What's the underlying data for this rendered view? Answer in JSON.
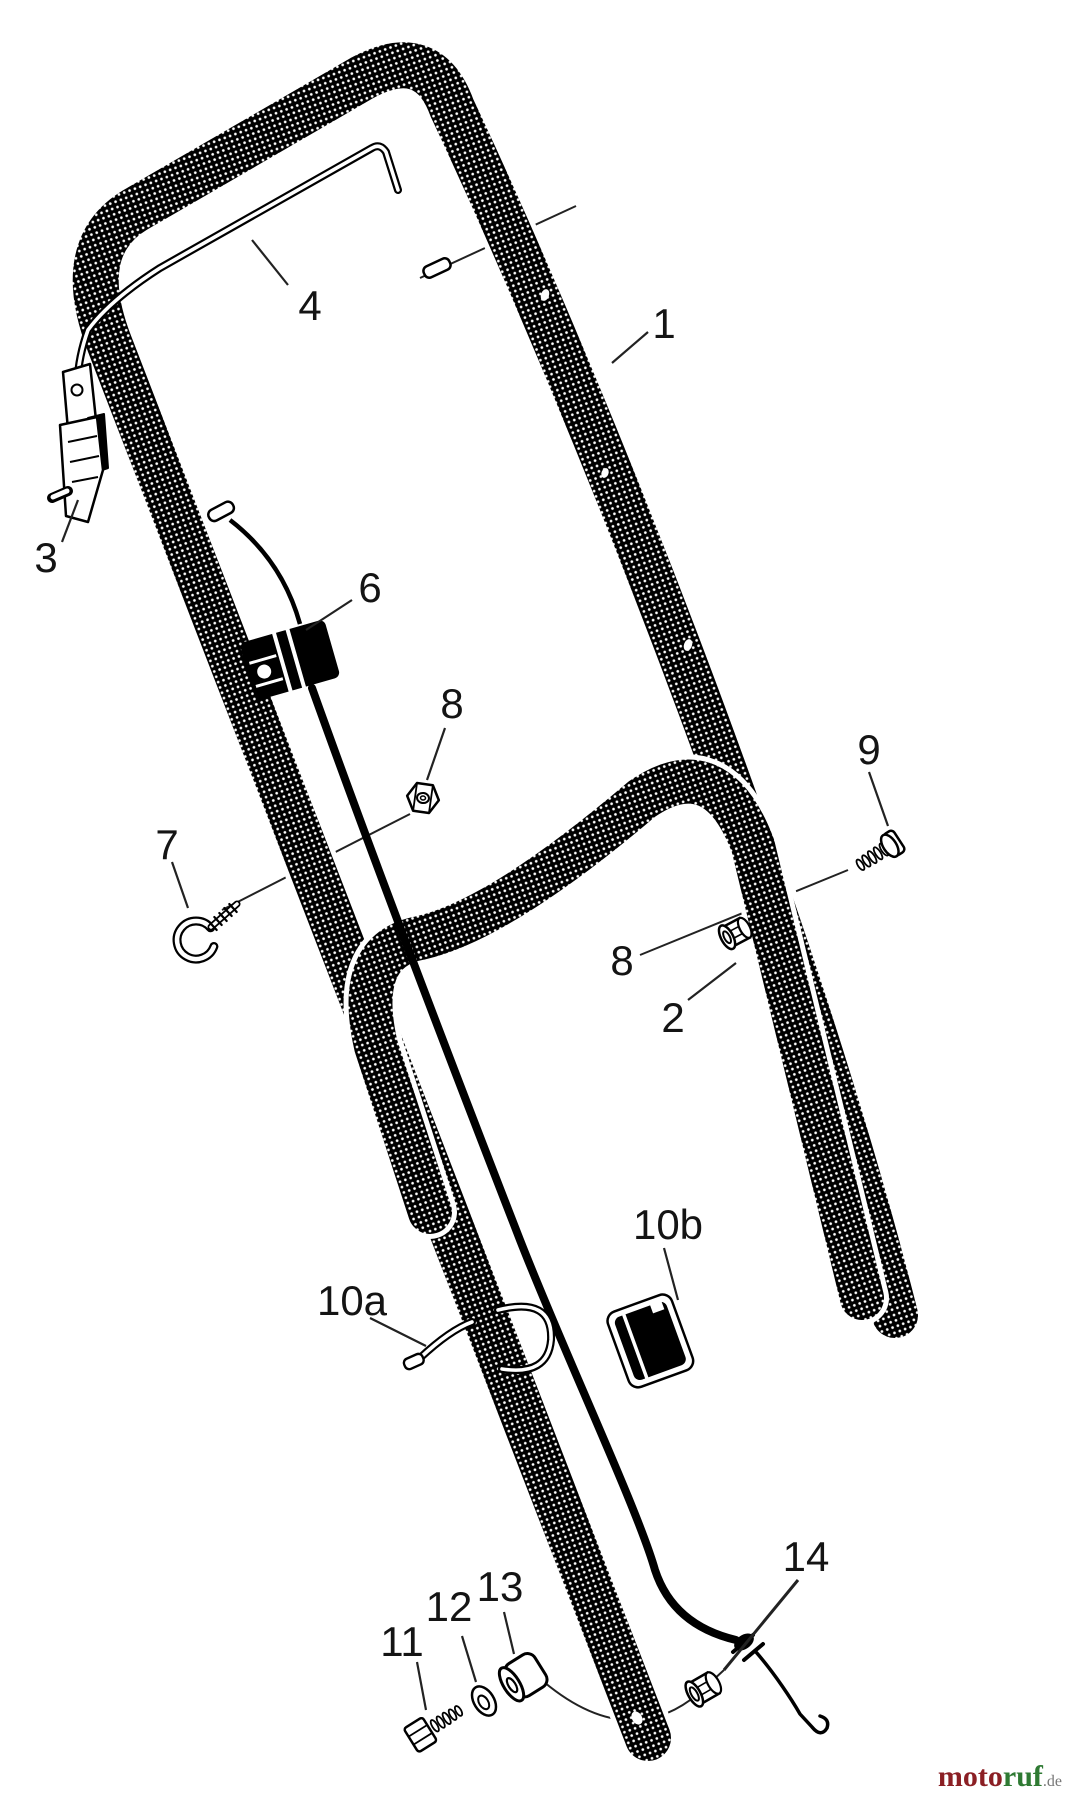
{
  "diagram": {
    "kind": "exploded parts diagram - mower handle assembly",
    "background_color": "#ffffff",
    "ink_color": "#000000",
    "leader_color": "#222222"
  },
  "labels": [
    {
      "id": "part-1",
      "text": "1"
    },
    {
      "id": "part-2",
      "text": "2"
    },
    {
      "id": "part-3",
      "text": "3"
    },
    {
      "id": "part-4",
      "text": "4"
    },
    {
      "id": "part-6",
      "text": "6"
    },
    {
      "id": "part-7",
      "text": "7"
    },
    {
      "id": "part-8a",
      "text": "8"
    },
    {
      "id": "part-8b",
      "text": "8"
    },
    {
      "id": "part-9",
      "text": "9"
    },
    {
      "id": "part-10a",
      "text": "10a"
    },
    {
      "id": "part-10b",
      "text": "10b"
    },
    {
      "id": "part-11",
      "text": "11"
    },
    {
      "id": "part-12",
      "text": "12"
    },
    {
      "id": "part-13",
      "text": "13"
    },
    {
      "id": "part-14",
      "text": "14"
    }
  ],
  "watermark": {
    "part1": "moto",
    "part2": "ruf",
    "suffix": ".de",
    "color_part1": "#8b1f24",
    "color_part2": "#2f7a33",
    "color_suffix": "#777777"
  }
}
